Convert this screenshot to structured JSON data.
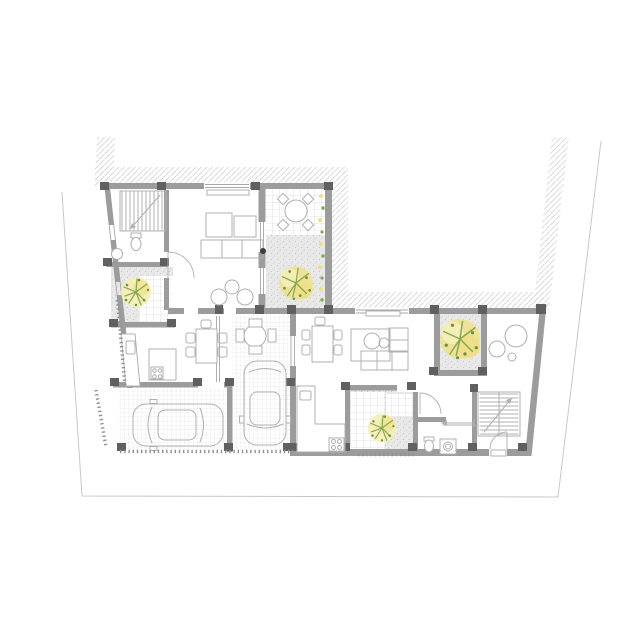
{
  "plan": {
    "type": "architectural-floor-plan",
    "level": "ground-floor",
    "elements": [
      "site-boundary",
      "party-wall-hatching",
      "unit-a",
      "unit-b",
      "courtyard-with-pergola-table",
      "planted-courtyards",
      "carport",
      "garage",
      "car-in-garage",
      "car-in-carport",
      "staircase-unit-a",
      "staircase-unit-b",
      "living-room-sofas",
      "dining-tables",
      "kitchen-counters",
      "bathrooms",
      "washing-machine",
      "trees",
      "door-swings",
      "window-openings"
    ]
  },
  "colors": {
    "paper": "#ffffff",
    "wall": "#9c9c9c",
    "wallDark": "#606060",
    "hatch": "#dbdbdb",
    "boundary": "#c8c8c8",
    "furn": "#b0b0b0",
    "win": "#a6a6a6",
    "grid": "#c9c9c9",
    "gridFine": "#dcdcdc",
    "gravelBg": "#e9e9e9",
    "gravelDot": "#c6c6c6",
    "treeYellow": "#eee089",
    "treeYellowLight": "#f5eeb4",
    "treeGreen": "#85a84e",
    "treeGreenDark": "#699140",
    "tick": "#919191",
    "column": "#3d3d3d"
  }
}
